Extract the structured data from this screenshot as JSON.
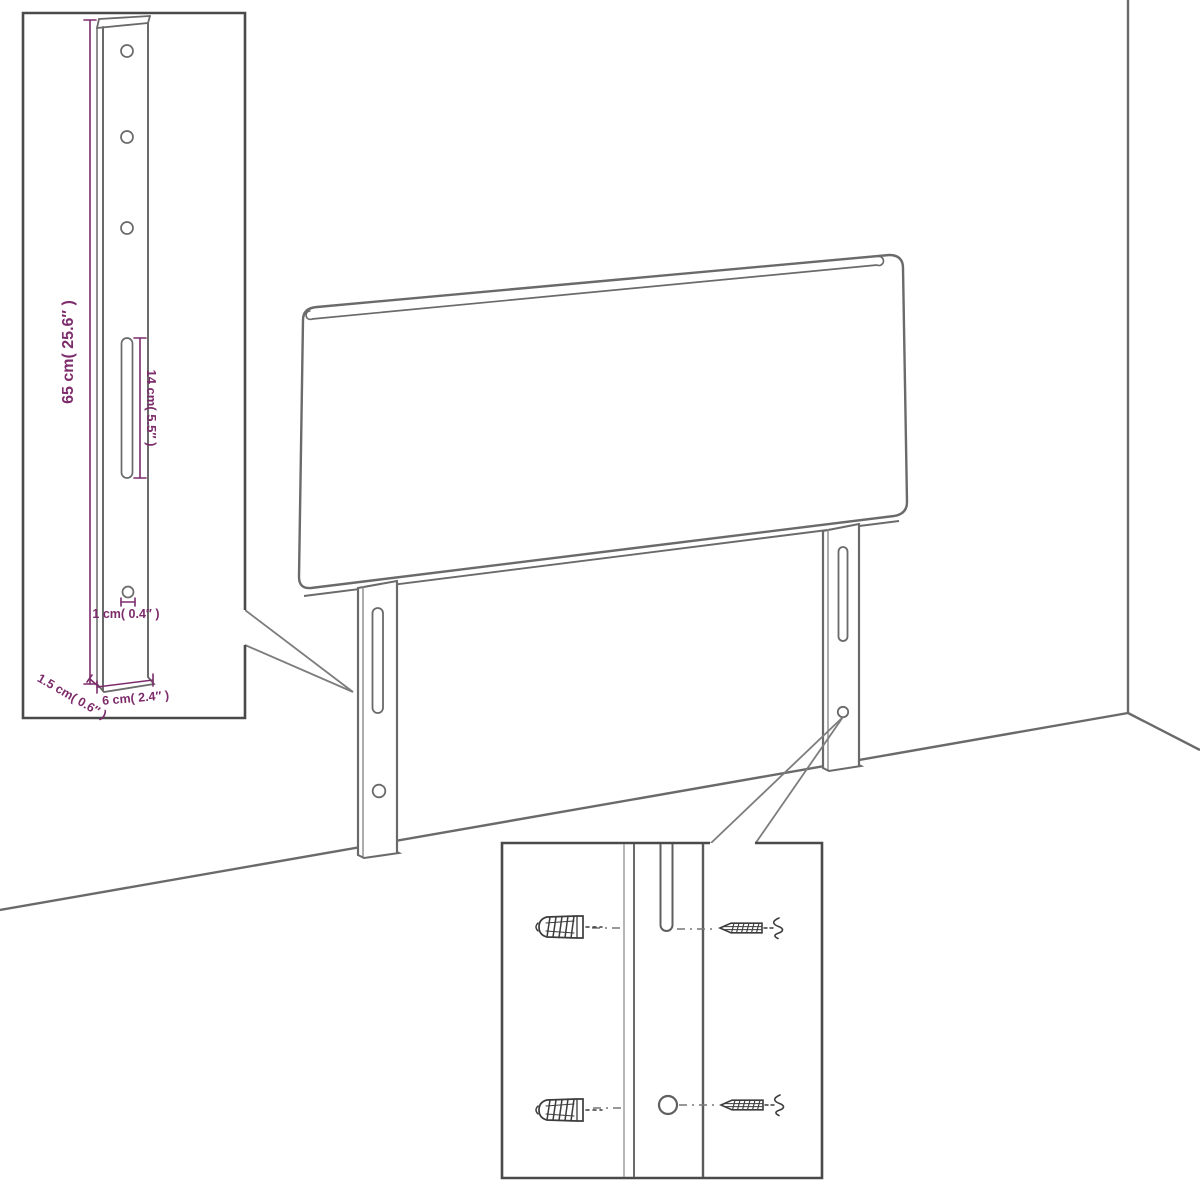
{
  "colors": {
    "background": "#ffffff",
    "artwork_line": "#6a6a6a",
    "inset_border": "#4a4a4a",
    "dimension": "#7d2c6b",
    "hardware": "#3c3c3c"
  },
  "insets": {
    "leg_detail": {
      "measurements": [
        {
          "name": "post-height",
          "label": "65 cm( 25.6″ )"
        },
        {
          "name": "slot-length",
          "label": "14 cm( 5.5″ )"
        },
        {
          "name": "hole-diameter",
          "label": "1 cm( 0.4″ )"
        },
        {
          "name": "post-depth",
          "label": "1.5 cm( 0.6″ )"
        },
        {
          "name": "post-width",
          "label": "6 cm( 2.4″ )"
        }
      ]
    },
    "mounting_detail": {
      "hardware": [
        {
          "name": "wall-plug-icon"
        },
        {
          "name": "screw-icon"
        }
      ]
    }
  }
}
